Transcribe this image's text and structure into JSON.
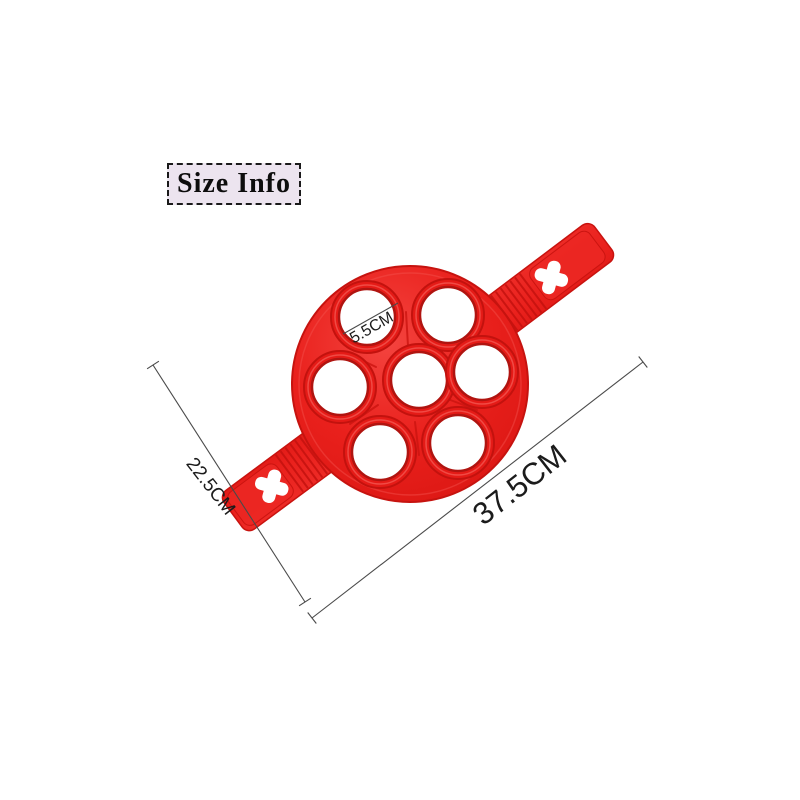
{
  "badge": {
    "label": "Size Info"
  },
  "annotations": {
    "hole_diameter": {
      "label": "5.5CM"
    },
    "width": {
      "label": "22.5CM"
    },
    "length": {
      "label": "37.5CM"
    }
  },
  "product": {
    "hole_count": 7,
    "colors": {
      "body_red": "#e9201c",
      "body_dark_red": "#c8130f",
      "highlight_red": "#f4615c",
      "cutout_white": "#ffffff",
      "badge_background": "#ece4ef",
      "dimension_line": "#4a4a4a",
      "page_background": "#ffffff"
    }
  }
}
